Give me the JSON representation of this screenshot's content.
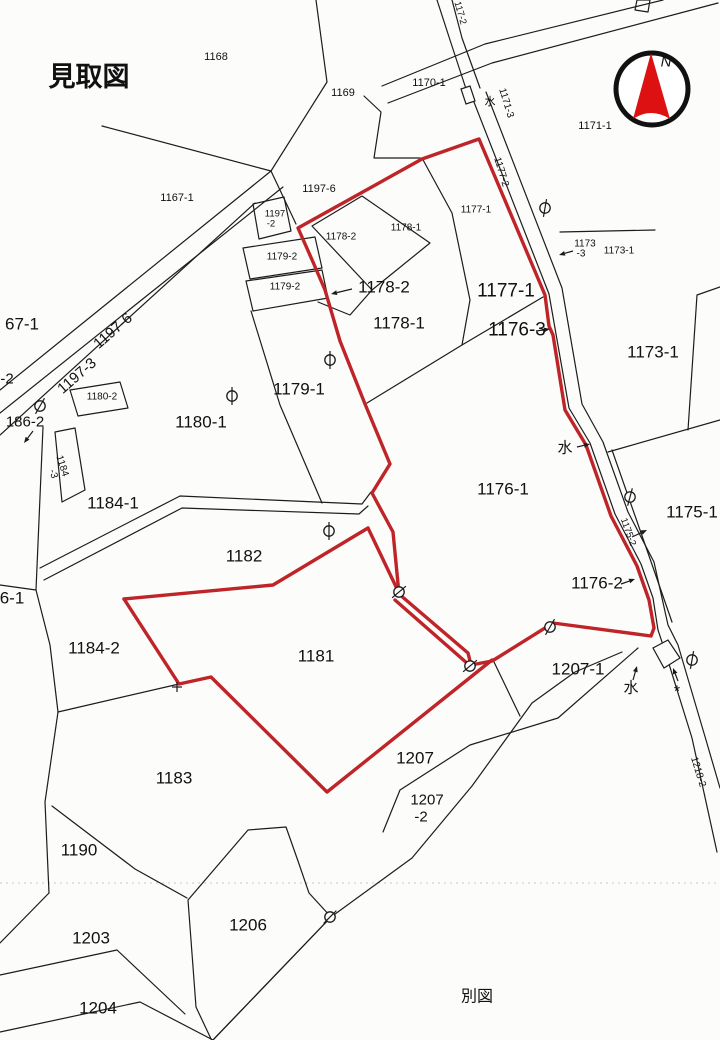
{
  "title": "見取図",
  "footer_note": "別図",
  "colors": {
    "boundary_red": "#bf2428",
    "compass_red": "#dd1111",
    "ink": "#1a1a1a"
  },
  "compass": {
    "label": "N",
    "cx": 652,
    "cy": 89,
    "r": 36
  },
  "labels": [
    {
      "name": "map-title",
      "text": "見取図",
      "x": 89,
      "y": 77,
      "size": 27,
      "bold": true
    },
    {
      "name": "label-1168",
      "text": "1168",
      "x": 216,
      "y": 57,
      "size": 11
    },
    {
      "name": "label-1169",
      "text": "1169",
      "x": 343,
      "y": 93,
      "size": 11
    },
    {
      "name": "label-1170-1",
      "text": "1170-1",
      "x": 429,
      "y": 83,
      "size": 11
    },
    {
      "name": "label-1171-1",
      "text": "1171-1",
      "x": 595,
      "y": 126,
      "size": 11
    },
    {
      "name": "label-1167-1",
      "text": "1167-1",
      "x": 177,
      "y": 198,
      "size": 11
    },
    {
      "name": "label-1197-6-small",
      "text": "1197-6",
      "x": 319,
      "y": 189,
      "size": 11
    },
    {
      "name": "label-1197-2a",
      "text": "1197",
      "x": 275,
      "y": 214,
      "size": 9.5
    },
    {
      "name": "label-1197-2b",
      "text": "-2",
      "x": 271,
      "y": 224,
      "size": 9.5
    },
    {
      "name": "label-1178-2-small",
      "text": "1178-2",
      "x": 341,
      "y": 237,
      "size": 10
    },
    {
      "name": "label-1178-1-small",
      "text": "1178-1",
      "x": 406,
      "y": 228,
      "size": 10
    },
    {
      "name": "label-1177-1-small",
      "text": "1177-1",
      "x": 476,
      "y": 210,
      "size": 10
    },
    {
      "name": "label-1179-2a",
      "text": "1179-2",
      "x": 282,
      "y": 257,
      "size": 10
    },
    {
      "name": "label-1179-2b",
      "text": "1179-2",
      "x": 285,
      "y": 287,
      "size": 10
    },
    {
      "name": "label-1178-2-big",
      "text": "1178-2",
      "x": 384,
      "y": 287,
      "size": 17
    },
    {
      "name": "label-1177-1-big",
      "text": "1177-1",
      "x": 506,
      "y": 291,
      "size": 19
    },
    {
      "name": "label-1178-1-big",
      "text": "1178-1",
      "x": 399,
      "y": 323,
      "size": 17
    },
    {
      "name": "label-1176-3",
      "text": "1176-3",
      "x": 517,
      "y": 330,
      "size": 19
    },
    {
      "name": "label-1173a",
      "text": "1173",
      "x": 585,
      "y": 244,
      "size": 10
    },
    {
      "name": "label-1173b",
      "text": "-3",
      "x": 581,
      "y": 254,
      "size": 10
    },
    {
      "name": "label-1173-1-small",
      "text": "1173-1",
      "x": 619,
      "y": 251,
      "size": 10
    },
    {
      "name": "label-1173-1-big",
      "text": "1173-1",
      "x": 653,
      "y": 352,
      "size": 17
    },
    {
      "name": "label-67-1",
      "text": "67-1",
      "x": 22,
      "y": 324,
      "size": 17
    },
    {
      "name": "label-1197-6-rot",
      "text": "1197-6",
      "x": 113,
      "y": 331,
      "size": 15,
      "rot": -41
    },
    {
      "name": "label-1197-3-rot",
      "text": "1197-3",
      "x": 77,
      "y": 376,
      "size": 15,
      "rot": -41
    },
    {
      "name": "label-minus2-edge",
      "text": "-2",
      "x": 7,
      "y": 379,
      "size": 15
    },
    {
      "name": "label-1180-2",
      "text": "1180-2",
      "x": 102,
      "y": 397,
      "size": 10
    },
    {
      "name": "label-186-2",
      "text": "186-2",
      "x": 25,
      "y": 422,
      "size": 15
    },
    {
      "name": "label-1184-3a",
      "text": "1184",
      "x": 62,
      "y": 466,
      "size": 10,
      "rot": 72
    },
    {
      "name": "label-1184-3b",
      "text": "-3",
      "x": 53,
      "y": 474,
      "size": 10,
      "rot": 72
    },
    {
      "name": "label-1180-1",
      "text": "1180-1",
      "x": 201,
      "y": 422,
      "size": 17
    },
    {
      "name": "label-1179-1",
      "text": "1179-1",
      "x": 299,
      "y": 389,
      "size": 17
    },
    {
      "name": "label-1184-1",
      "text": "1184-1",
      "x": 113,
      "y": 503,
      "size": 17
    },
    {
      "name": "label-water-mid",
      "text": "水",
      "x": 565,
      "y": 448,
      "size": 15
    },
    {
      "name": "label-1176-1",
      "text": "1176-1",
      "x": 503,
      "y": 489,
      "size": 17
    },
    {
      "name": "label-1175-1",
      "text": "1175-1",
      "x": 692,
      "y": 512,
      "size": 17
    },
    {
      "name": "label-1175-2-rot",
      "text": "1175-2",
      "x": 628,
      "y": 532,
      "size": 9.5,
      "rot": 70
    },
    {
      "name": "label-1176-2",
      "text": "1176-2",
      "x": 597,
      "y": 583,
      "size": 17
    },
    {
      "name": "label-1182",
      "text": "1182",
      "x": 244,
      "y": 556,
      "size": 17
    },
    {
      "name": "label-6-1",
      "text": "6-1",
      "x": 12,
      "y": 598,
      "size": 17
    },
    {
      "name": "label-1184-2",
      "text": "1184-2",
      "x": 94,
      "y": 648,
      "size": 17
    },
    {
      "name": "label-1181",
      "text": "1181",
      "x": 316,
      "y": 656,
      "size": 17
    },
    {
      "name": "label-1207-1",
      "text": "1207-1",
      "x": 578,
      "y": 669,
      "size": 17
    },
    {
      "name": "label-water-bottom",
      "text": "水",
      "x": 631,
      "y": 688,
      "size": 15
    },
    {
      "name": "label-asterisk-bottom",
      "text": "*",
      "x": 677,
      "y": 692,
      "size": 16
    },
    {
      "name": "label-1218-2-rot",
      "text": "1218-2",
      "x": 698,
      "y": 772,
      "size": 10,
      "rot": 73
    },
    {
      "name": "label-1183",
      "text": "1183",
      "x": 174,
      "y": 778,
      "size": 17
    },
    {
      "name": "label-1207",
      "text": "1207",
      "x": 415,
      "y": 758,
      "size": 17
    },
    {
      "name": "label-1207-2a",
      "text": "1207",
      "x": 427,
      "y": 800,
      "size": 15
    },
    {
      "name": "label-1207-2b",
      "text": "-2",
      "x": 421,
      "y": 817,
      "size": 15
    },
    {
      "name": "label-1190",
      "text": "1190",
      "x": 79,
      "y": 850,
      "size": 17
    },
    {
      "name": "label-1203",
      "text": "1203",
      "x": 91,
      "y": 938,
      "size": 17
    },
    {
      "name": "label-1206",
      "text": "1206",
      "x": 248,
      "y": 925,
      "size": 17
    },
    {
      "name": "label-1204",
      "text": "1204",
      "x": 98,
      "y": 1008,
      "size": 17
    },
    {
      "name": "separate-map-note",
      "text": "別図",
      "x": 477,
      "y": 997,
      "size": 16
    },
    {
      "name": "compass-n-label",
      "text": "N",
      "x": 666,
      "y": 62,
      "size": 15,
      "italic": true
    },
    {
      "name": "label-water-top",
      "text": "水",
      "x": 490,
      "y": 102,
      "size": 11
    },
    {
      "name": "label-117-2-rot",
      "text": "117-2",
      "x": 460,
      "y": 13,
      "size": 9.5,
      "rot": 74
    },
    {
      "name": "label-1171-3-rot",
      "text": "1171-3",
      "x": 506,
      "y": 103,
      "size": 10,
      "rot": 73
    },
    {
      "name": "label-1177-2-rot",
      "text": "1177-2",
      "x": 501,
      "y": 172,
      "size": 10,
      "rot": 73
    }
  ],
  "markers": [
    {
      "x": 545,
      "y": 208,
      "a": 80
    },
    {
      "x": 40,
      "y": 406,
      "a": 60
    },
    {
      "x": 232,
      "y": 396,
      "a": 90
    },
    {
      "x": 330,
      "y": 360,
      "a": 90
    },
    {
      "x": 329,
      "y": 531,
      "a": 90
    },
    {
      "x": 399,
      "y": 592,
      "a": 40
    },
    {
      "x": 470,
      "y": 666,
      "a": 40
    },
    {
      "x": 550,
      "y": 627,
      "a": 60
    },
    {
      "x": 630,
      "y": 497,
      "a": 75
    },
    {
      "x": 692,
      "y": 660,
      "a": 80
    },
    {
      "x": 330,
      "y": 917,
      "a": 45
    }
  ],
  "plus_marks": [
    {
      "x": 177,
      "y": 687
    }
  ],
  "arrows": [
    {
      "x1": 352,
      "y1": 289,
      "x2": 331,
      "y2": 294
    },
    {
      "x1": 33,
      "y1": 431,
      "x2": 24,
      "y2": 443
    },
    {
      "x1": 536,
      "y1": 331,
      "x2": 550,
      "y2": 329
    },
    {
      "x1": 577,
      "y1": 447,
      "x2": 590,
      "y2": 444
    },
    {
      "x1": 632,
      "y1": 537,
      "x2": 647,
      "y2": 530
    },
    {
      "x1": 621,
      "y1": 584,
      "x2": 635,
      "y2": 579
    },
    {
      "x1": 573,
      "y1": 251,
      "x2": 559,
      "y2": 255
    },
    {
      "x1": 633,
      "y1": 680,
      "x2": 637,
      "y2": 666
    },
    {
      "x1": 678,
      "y1": 681,
      "x2": 673,
      "y2": 668
    }
  ]
}
